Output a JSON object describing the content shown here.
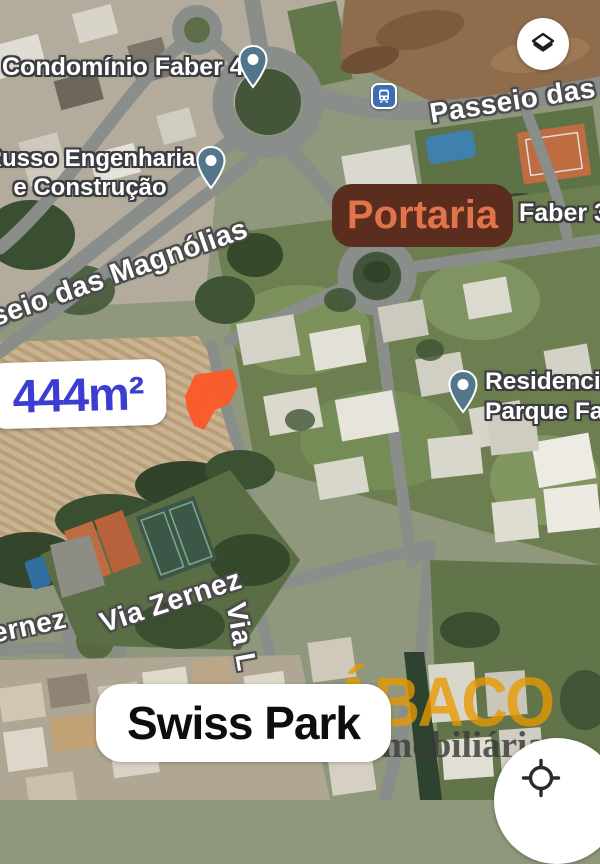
{
  "map": {
    "poi_labels": {
      "condominio_faber4": "Condomínio Faber 4",
      "russo_line1": "Russo Engenharia",
      "russo_line2": "e Construção",
      "faber3": "Faber 3",
      "residencial_line1": "Residencial",
      "residencial_line2": "Parque Fab"
    },
    "street_labels": {
      "passeio_das_m": "Passeio das M",
      "passeio_das_magnolias": "seio das Magnólias",
      "via_zernez": "Via Zernez",
      "via_zernez_partial": "ernez",
      "via_l": "Via L"
    },
    "annotations": {
      "portaria": "Portaria",
      "area": "444m²",
      "swiss_park": "Swiss Park"
    },
    "watermark": {
      "brand": "ÁBACO",
      "subtitle": "Imobiliária"
    },
    "icons": {
      "layers": "layers-icon",
      "bus_stop": "bus-stop-icon",
      "map_pin": "map-pin-icon",
      "locate": "crosshair-locate-icon"
    },
    "colors": {
      "portaria_bg": "#5a2d1f",
      "portaria_text": "#e2744b",
      "area_text": "#3d3ed1",
      "plot_fill": "#fb5a2a",
      "watermark_brand": "#e89a00",
      "watermark_subtitle": "#3a3a3a",
      "pin_fill": "#54768b",
      "bus_icon_bg": "#3d6db5",
      "label_outline": "#4b4b4b"
    }
  }
}
